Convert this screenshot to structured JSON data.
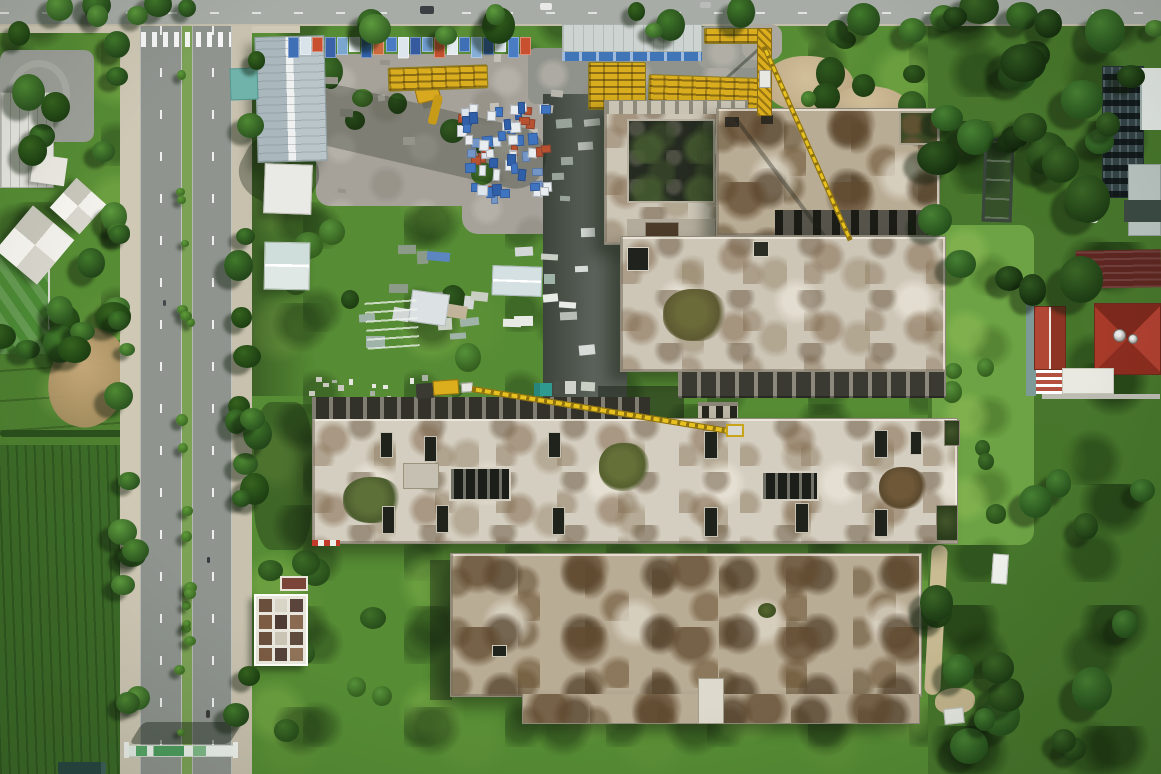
{
  "meta": {
    "title": "Aerial drone photograph of an unfinished concrete building complex beside a tree-lined boulevard",
    "width": 1161,
    "height": 774
  },
  "palette": {
    "vegBase": "#568c34",
    "vegDark": "#2c4b21",
    "asphalt": "#8f948f",
    "asphaltTop": "#a7aca6",
    "sidewalk": "#cfc8b5",
    "gravel": "#a6a29a",
    "concrete": "#cdc6b7",
    "mossBrown": "#7d6347",
    "openingDark": "#20231c",
    "craneYellow": "#dcae1d",
    "palletBlue": "#3f74c1",
    "warehouseRoof": "#b8c3c7",
    "tealShed": "#6fb3ab",
    "redRoof": "#9c3425",
    "darkRedRoof": "#5e2621",
    "towerFacade": "#334246",
    "dirt": "#c7b28c",
    "gateGreen": "#57a868"
  },
  "scene": {
    "gridCells": [
      "#6b4f3d",
      "#d9d5c6",
      "#5a443c",
      "#7d5c44",
      "#4e3c34",
      "#8a6a50",
      "#6b4f3d",
      "#c9c4b4",
      "#5f4a3e",
      "#7a5a42",
      "#54423a",
      "#8f7258"
    ],
    "bannerColors": [
      "#3f6fb5",
      "#d9e3ea",
      "#c9502f",
      "#3a62a8",
      "#7aa6d0",
      "#e8eef2",
      "#2f5fa8",
      "#cd6a3d",
      "#4a7cc4",
      "#dde6ec",
      "#355a9e",
      "#6f9cce",
      "#c4512e",
      "#e4ebf0",
      "#3f6fb5",
      "#86aed6",
      "#2c5492",
      "#d7e1e8",
      "#4a7cc4",
      "#c9502f"
    ],
    "banner": {
      "x": 288,
      "y": 37,
      "step": 12.2,
      "w": 11,
      "h": 21
    },
    "shafts": [
      [
        380,
        432,
        13,
        26
      ],
      [
        424,
        436,
        13,
        26
      ],
      [
        548,
        432,
        13,
        26
      ],
      [
        704,
        431,
        14,
        28
      ],
      [
        874,
        430,
        14,
        28
      ],
      [
        910,
        431,
        12,
        24
      ],
      [
        382,
        506,
        13,
        28
      ],
      [
        436,
        505,
        13,
        28
      ],
      [
        552,
        507,
        13,
        28
      ],
      [
        704,
        507,
        14,
        30
      ],
      [
        795,
        503,
        14,
        30
      ],
      [
        874,
        509,
        14,
        28
      ]
    ],
    "generators": [
      {
        "name": "shrub",
        "count": 40,
        "round": true,
        "z": 2,
        "w": [
          14,
          30
        ],
        "zones": [
          [
            255,
            200,
            280,
            200
          ],
          [
            255,
            545,
            190,
            215
          ],
          [
            935,
            300,
            90,
            460
          ],
          [
            300,
            60,
            240,
            120
          ],
          [
            760,
            30,
            170,
            80
          ]
        ],
        "pairs": [
          [
            "#3f7029",
            "#274d1a"
          ],
          [
            "#56923a",
            "#35601f"
          ],
          [
            "#2f5a1f",
            "#1f3d12"
          ]
        ]
      },
      {
        "name": "gravel-speck",
        "count": 14,
        "z": 2,
        "w": [
          6,
          14
        ],
        "h": [
          4,
          9
        ],
        "rot": 10,
        "zones": [
          [
            320,
            56,
            240,
            148
          ]
        ],
        "colors": [
          "#b8b5ac",
          "#96938a",
          "#c4c1b8"
        ]
      },
      {
        "name": "roadside-pallet",
        "count": 13,
        "z": 3,
        "w": [
          8,
          18
        ],
        "h": [
          5,
          10
        ],
        "rot": 8,
        "zones": [
          [
            543,
            118,
            55,
            270
          ]
        ],
        "colors": [
          "#d8dcd8",
          "#e9ebe7",
          "#b8beb6",
          "#9aa39a",
          "#c9cfc4"
        ]
      },
      {
        "name": "stored-material",
        "count": 20,
        "z": 3,
        "w": [
          10,
          24
        ],
        "h": [
          6,
          13
        ],
        "rot": 10,
        "zones": [
          [
            362,
            248,
            190,
            100
          ]
        ],
        "colors": [
          "#d3d8d6",
          "#e8eae6",
          "#9fb3a8",
          "#5b86c0",
          "#c9cfc2",
          "#8c9a88",
          "#c2b49a"
        ]
      },
      {
        "name": "pallet-stack",
        "cls": "pall",
        "count": 66,
        "z": 4,
        "w": [
          7,
          11
        ],
        "h": [
          8,
          12
        ],
        "rot": 5,
        "zones": [
          [
            452,
            106,
            94,
            52
          ],
          [
            468,
            140,
            80,
            60
          ]
        ],
        "colors": [
          "#3f74c1",
          "#e9edf0",
          "#3f74c1",
          "#dde5ec",
          "#7396c7",
          "#b8512f",
          "#2f5fa8",
          "#e9edf0"
        ]
      },
      {
        "name": "ground-mark",
        "count": 13,
        "z": 3,
        "w": [
          4,
          7
        ],
        "h": [
          3,
          6
        ],
        "zones": [
          [
            312,
            378,
            118,
            22
          ]
        ],
        "colors": [
          "#e8e8e2",
          "#c9c9c0",
          "#a8b0a4"
        ]
      },
      {
        "name": "tree",
        "cls": "tree",
        "count": 22,
        "round": true,
        "shadow": true,
        "z": 8,
        "w": [
          16,
          34
        ],
        "zones": [
          [
            0,
            2,
            1161,
            34
          ]
        ],
        "pairs": [
          [
            "#4f8a33",
            "#2c5520"
          ],
          [
            "#417a2b",
            "#24471a"
          ],
          [
            "#5d9a3d",
            "#336024"
          ],
          [
            "#36641f",
            "#1d3f12"
          ]
        ]
      },
      {
        "name": "tree",
        "cls": "tree",
        "count": 15,
        "round": true,
        "shadow": true,
        "z": 8,
        "w": [
          16,
          30
        ],
        "zones": [
          [
            112,
            40,
            26,
            720
          ]
        ],
        "pairs": [
          [
            "#4f8a33",
            "#2c5520"
          ],
          [
            "#417a2b",
            "#24471a"
          ],
          [
            "#5d9a3d",
            "#336024"
          ]
        ]
      },
      {
        "name": "tree",
        "cls": "tree",
        "count": 15,
        "round": true,
        "shadow": true,
        "z": 8,
        "w": [
          16,
          30
        ],
        "zones": [
          [
            232,
            40,
            26,
            700
          ]
        ],
        "pairs": [
          [
            "#4f8a33",
            "#2c5520"
          ],
          [
            "#417a2b",
            "#24471a"
          ],
          [
            "#36641f",
            "#1d3f12"
          ]
        ]
      },
      {
        "name": "median-tree",
        "cls": "tree",
        "count": 19,
        "round": true,
        "shadow": true,
        "z": 8,
        "w": [
          7,
          13
        ],
        "zones": [
          [
            179,
            48,
            12,
            700
          ]
        ],
        "pairs": [
          [
            "#5f9c3a",
            "#3c6b24"
          ]
        ]
      },
      {
        "name": "tree",
        "cls": "tree",
        "count": 16,
        "round": true,
        "shadow": true,
        "z": 8,
        "w": [
          18,
          36
        ],
        "zones": [
          [
            0,
            30,
            118,
            150
          ],
          [
            60,
            260,
            60,
            90
          ],
          [
            0,
            330,
            120,
            30
          ]
        ],
        "pairs": [
          [
            "#4f8a33",
            "#2c5520"
          ],
          [
            "#417a2b",
            "#24471a"
          ],
          [
            "#36641f",
            "#1d3f12"
          ]
        ]
      },
      {
        "name": "tree",
        "cls": "tree",
        "count": 26,
        "round": true,
        "shadow": true,
        "z": 8,
        "w": [
          22,
          46
        ],
        "zones": [
          [
            935,
            0,
            226,
            150
          ],
          [
            935,
            130,
            170,
            160
          ]
        ],
        "pairs": [
          [
            "#3a6526",
            "#1e3d14"
          ],
          [
            "#2f5720",
            "#152e0e"
          ],
          [
            "#478033",
            "#26511c"
          ]
        ]
      },
      {
        "name": "tree",
        "cls": "tree",
        "count": 16,
        "round": true,
        "shadow": true,
        "z": 8,
        "w": [
          20,
          40
        ],
        "zones": [
          [
            1030,
            420,
            131,
            340
          ],
          [
            935,
            560,
            80,
            200
          ]
        ],
        "pairs": [
          [
            "#3a6526",
            "#1e3d14"
          ],
          [
            "#478033",
            "#26511c"
          ]
        ]
      }
    ]
  }
}
